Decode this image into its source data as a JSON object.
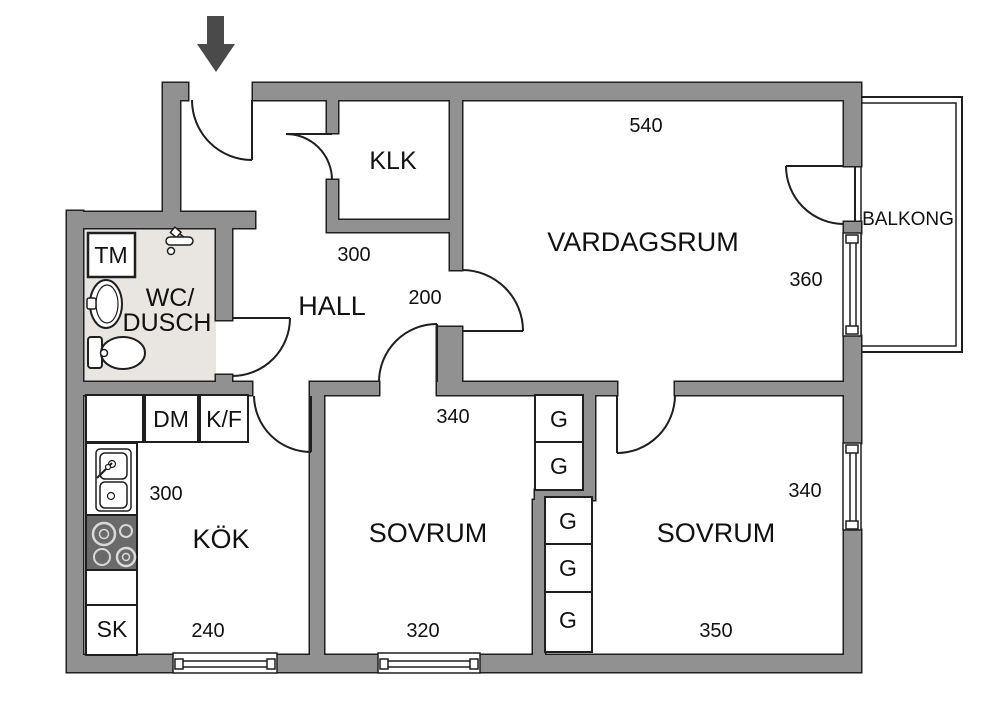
{
  "floorplan": {
    "rooms": {
      "vardagsrum": {
        "name": "VARDAGSRUM",
        "dim_width": "540",
        "dim_height": "360"
      },
      "balkong": {
        "name": "BALKONG"
      },
      "klk": {
        "name": "KLK"
      },
      "hall": {
        "name": "HALL",
        "dim_width": "300",
        "dim_opening": "200"
      },
      "wc_dusch": {
        "name_line1": "WC/",
        "name_line2": "DUSCH"
      },
      "kok": {
        "name": "KÖK",
        "dim_height": "300",
        "dim_width": "240"
      },
      "sovrum_1": {
        "name": "SOVRUM",
        "dim_top": "340",
        "dim_width": "320"
      },
      "sovrum_2": {
        "name": "SOVRUM",
        "dim_height": "340",
        "dim_width": "350"
      }
    },
    "fixtures": {
      "washing_machine": "TM",
      "dishwasher": "DM",
      "fridge_freezer": "K/F",
      "cleaning_closet": "SK",
      "wardrobe": "G"
    },
    "colors": {
      "wall": "#919191",
      "outline": "#1f1f1f",
      "wc_floor": "#e9e5e0",
      "arrow": "#4a4a4a",
      "stove": "#6a6a6a"
    }
  }
}
